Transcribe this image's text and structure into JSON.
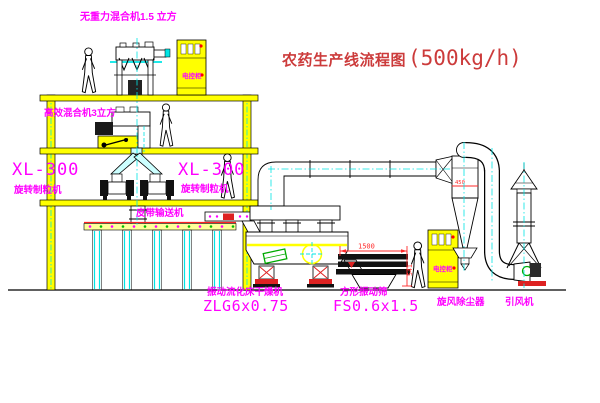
{
  "title": {
    "text": "农药生产线流程图",
    "capacity": "(500kg/h)"
  },
  "labels": {
    "gravity_mixer": "无重力混合机1.5 立方",
    "high_eff_mixer": "高效混合机3立方",
    "granulator_left_model": "XL-300",
    "granulator_left_name": "旋转制粒机",
    "granulator_center_model": "XL-300",
    "granulator_center_name": "旋转制粒机",
    "belt_conveyor": "皮带输送机",
    "dryer_name": "振动流化床干燥机",
    "dryer_model": "ZLG6x0.75",
    "screen_name": "方形振动筛",
    "screen_model": "FS0.6x1.5",
    "cyclone": "旋风除尘器",
    "fan": "引风机",
    "cabinet": "电控柜"
  },
  "dimensions": {
    "screen_length": "1500",
    "screen_height": "541",
    "cyclone_diameter": "450"
  },
  "colors": {
    "label": "#ff00ff",
    "title": "#cc3b3b",
    "structure": "#ffff00",
    "centerline": "#00e5e5",
    "dimension": "#ff2a2a"
  }
}
